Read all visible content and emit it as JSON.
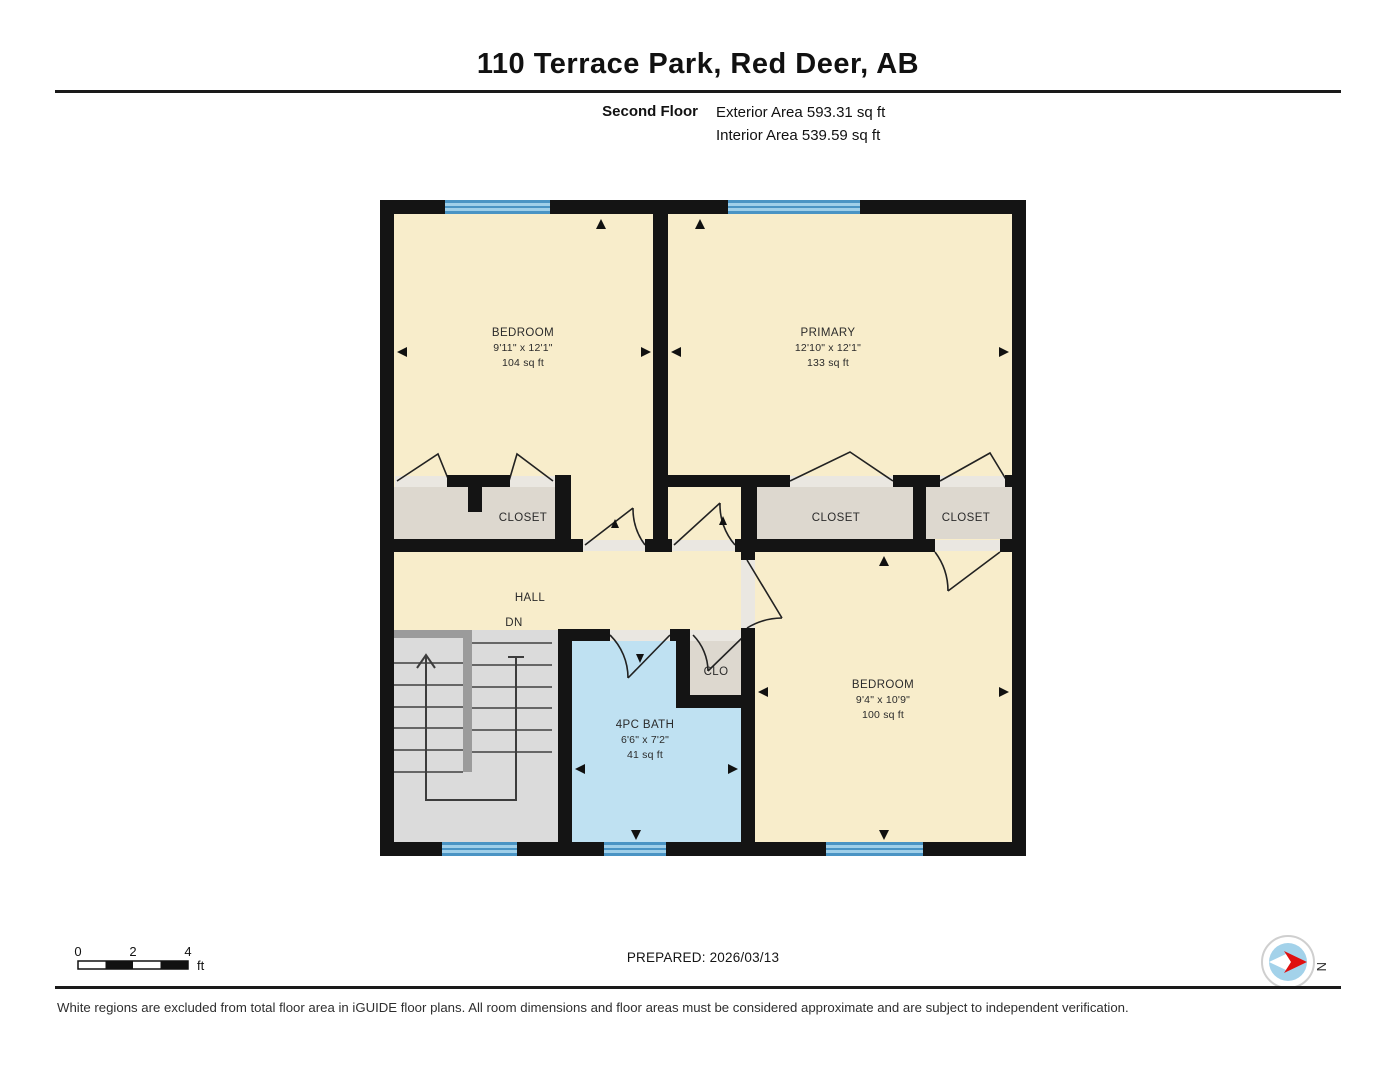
{
  "header": {
    "title": "110 Terrace Park, Red Deer, AB",
    "floor_label": "Second Floor",
    "exterior_area": "Exterior Area 593.31 sq ft",
    "interior_area": "Interior Area 539.59 sq ft"
  },
  "rooms": {
    "bedroom_left": {
      "name": "BEDROOM",
      "dims": "9'11\" x 12'1\"",
      "area": "104 sq ft"
    },
    "primary": {
      "name": "PRIMARY",
      "dims": "12'10\" x 12'1\"",
      "area": "133 sq ft"
    },
    "closet_left": {
      "name": "CLOSET"
    },
    "closet_middle": {
      "name": "CLOSET"
    },
    "closet_right": {
      "name": "CLOSET"
    },
    "hall": {
      "name": "HALL",
      "annotation": "DN"
    },
    "bath": {
      "name": "4PC BATH",
      "dims": "6'6\" x 7'2\"",
      "area": "41 sq ft"
    },
    "clo": {
      "name": "CLO"
    },
    "bedroom_bottom": {
      "name": "BEDROOM",
      "dims": "9'4\" x 10'9\"",
      "area": "100 sq ft"
    }
  },
  "scale_bar": {
    "tick_0": "0",
    "tick_2": "2",
    "tick_4": "4",
    "unit": "ft"
  },
  "compass": {
    "label": "N"
  },
  "footer": {
    "prepared": "PREPARED: 2026/03/13",
    "disclaimer": "White regions are excluded from total floor area in iGUIDE floor plans. All room dimensions and floor areas must be considered approximate and are subject to independent verification."
  },
  "colors": {
    "room_fill": "#f8edcb",
    "closet_fill": "#ddd8cf",
    "bath_fill": "#bfe1f2",
    "stairs_fill": "#dbdbdb",
    "wall": "#141414",
    "window_blue": "#4a94c4",
    "window_light": "#9fcfe9",
    "compass_blue": "#a3d2ea",
    "compass_red": "#e01010"
  }
}
